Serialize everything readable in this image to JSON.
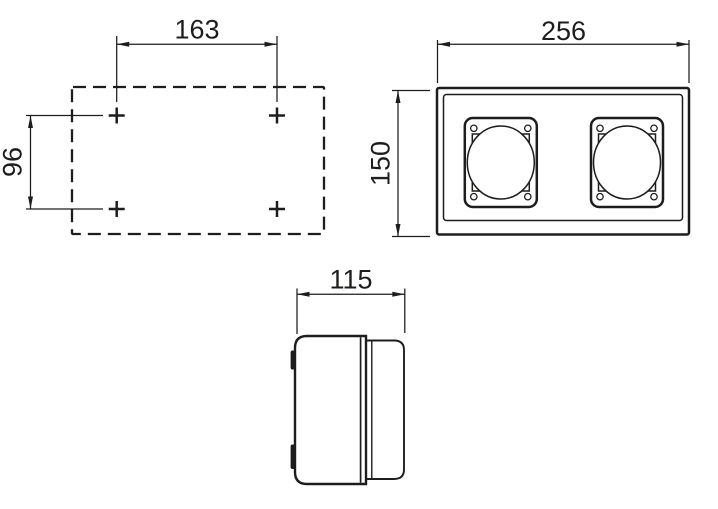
{
  "dimensions": {
    "hole_spacing_horizontal": "163",
    "hole_spacing_vertical": "96",
    "front_width": "256",
    "front_height": "150",
    "side_depth": "115"
  },
  "colors": {
    "line": "#1d1d1b",
    "background": "#ffffff"
  }
}
